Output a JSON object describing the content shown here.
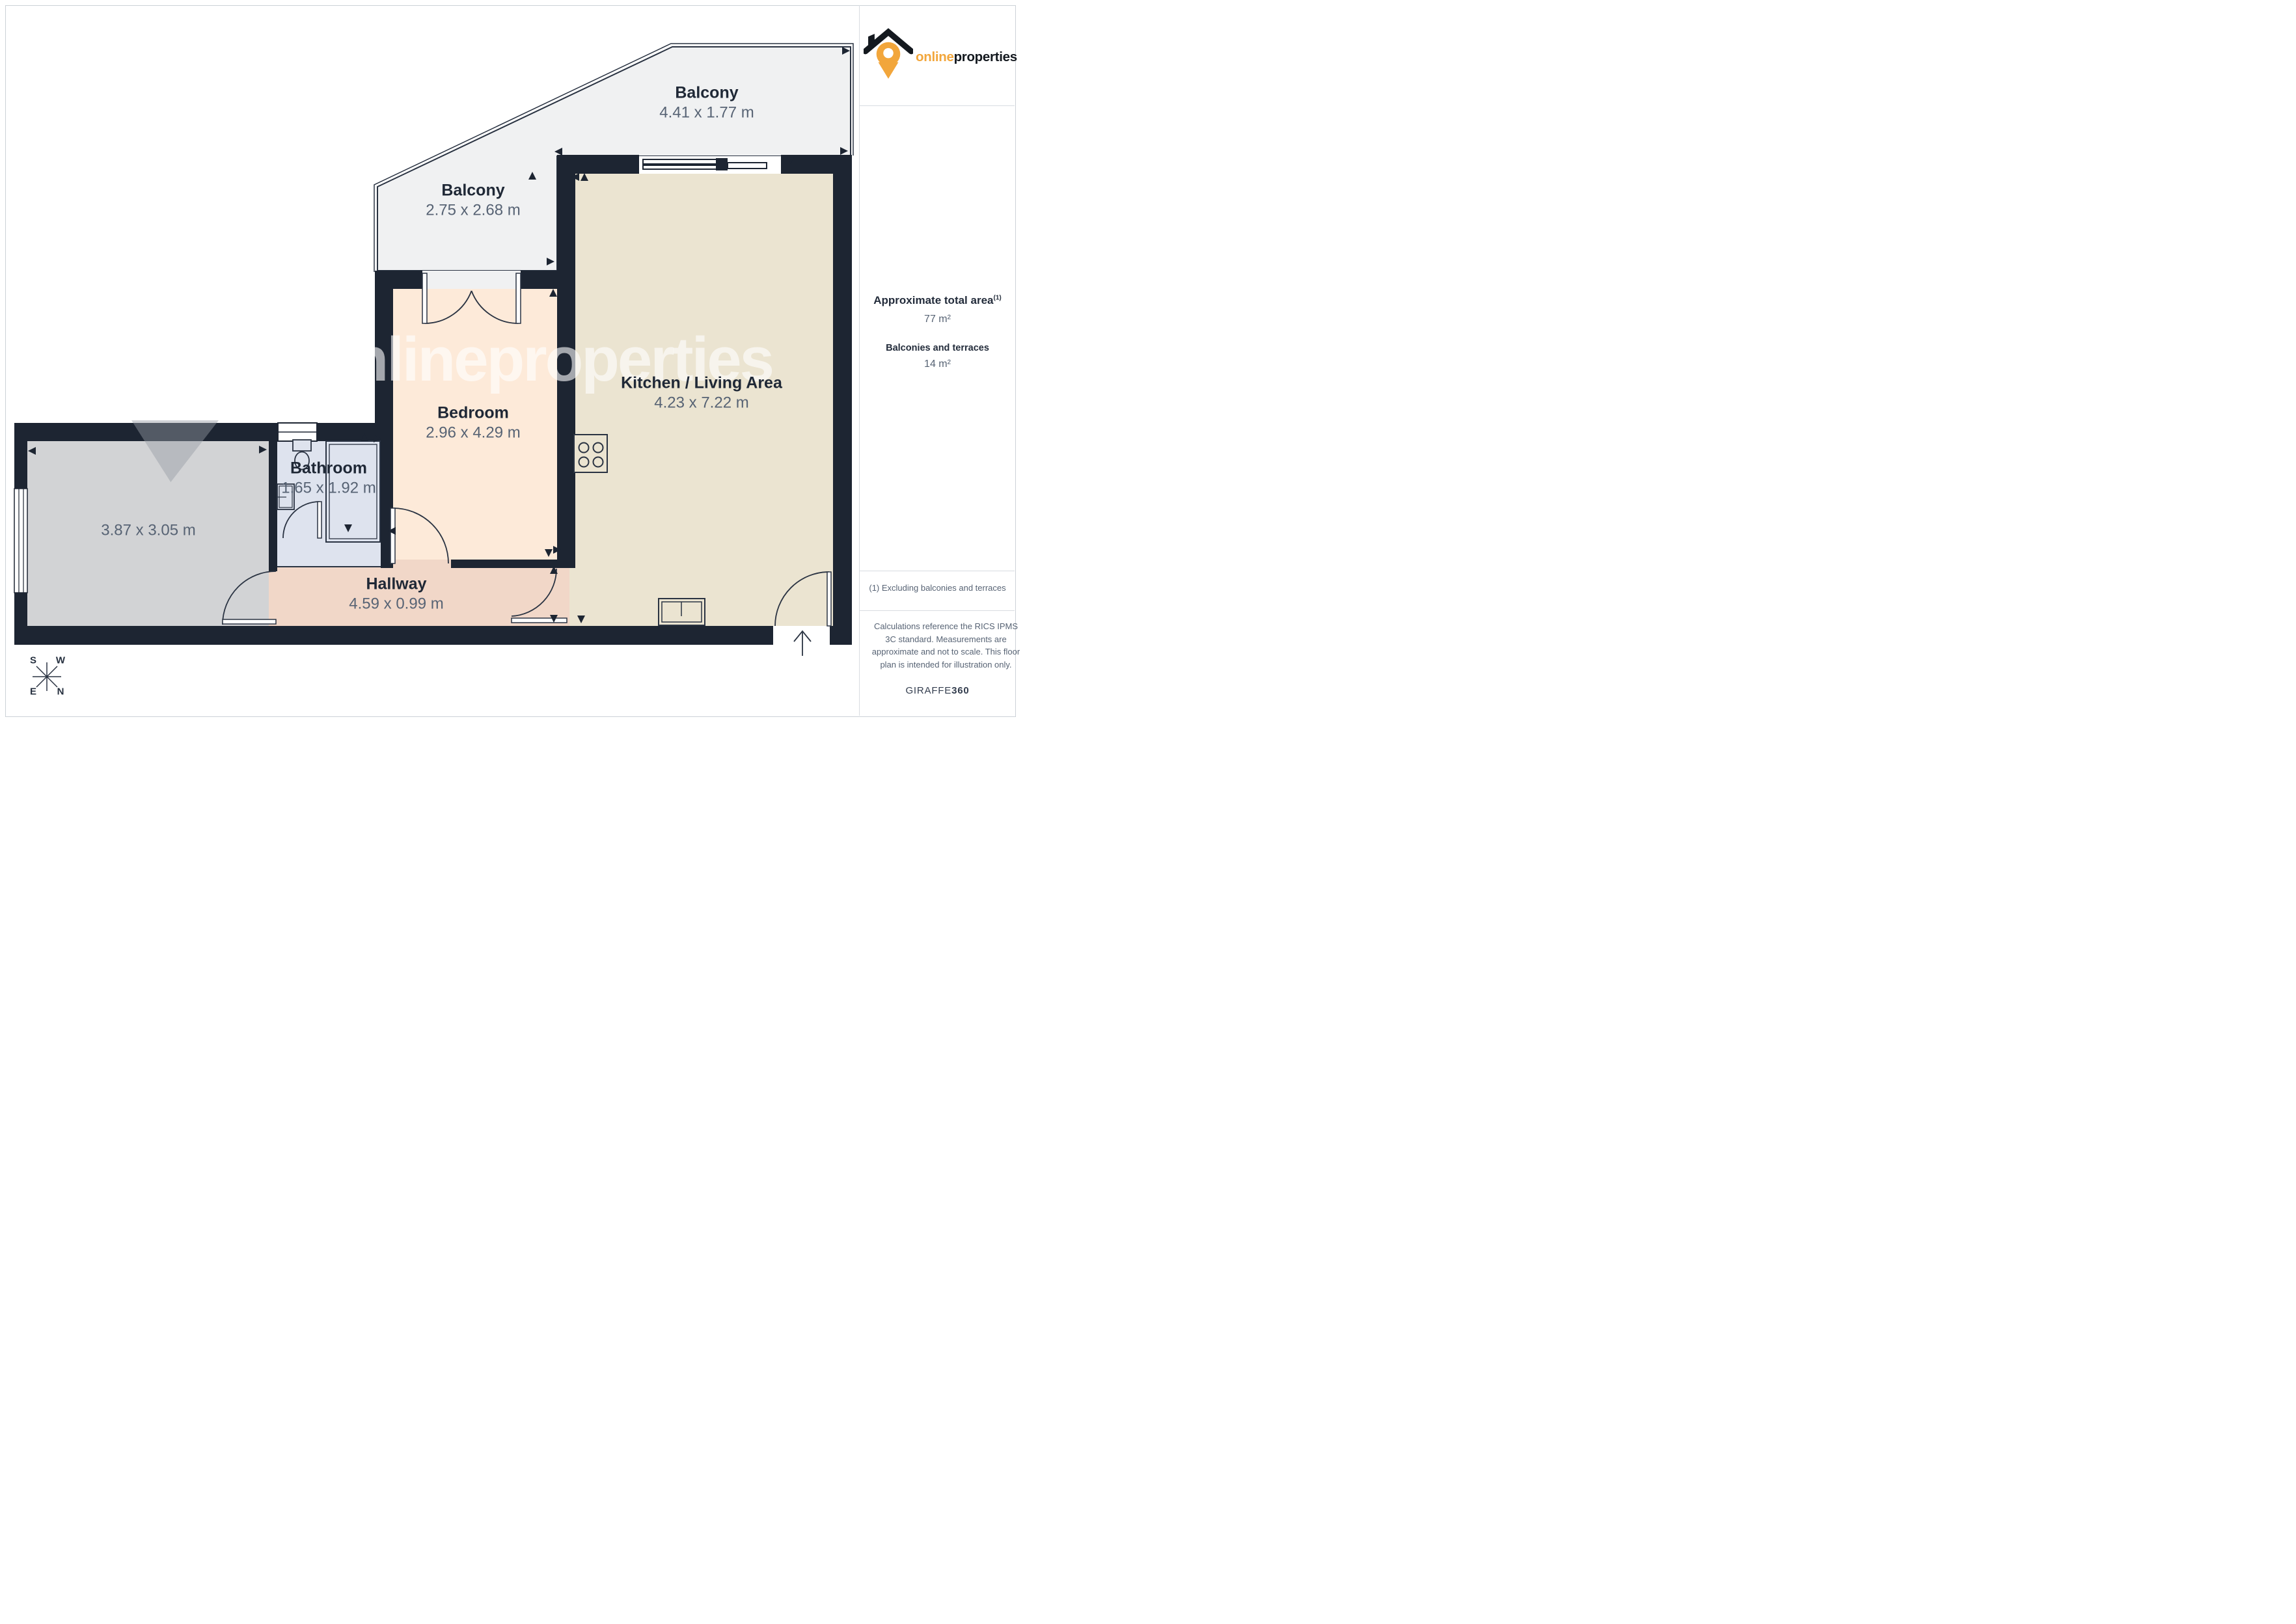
{
  "watermark": {
    "text": "onlineproperties"
  },
  "logo": {
    "online": "online",
    "properties": "properties"
  },
  "rooms": [
    {
      "name": "Balcony",
      "dims": "4.41 x 1.77 m"
    },
    {
      "name": "Balcony",
      "dims": "2.75 x 2.68 m"
    },
    {
      "name": "Kitchen / Living Area",
      "dims": "4.23 x 7.22 m"
    },
    {
      "name": "Bedroom",
      "dims": "2.96 x 4.29 m"
    },
    {
      "name": "Bathroom",
      "dims": "1.65 x 1.92 m"
    },
    {
      "name": "Hallway",
      "dims": "4.59 x 0.99 m"
    },
    {
      "name": "",
      "dims": "3.87 x 3.05 m"
    }
  ],
  "sidebar": {
    "area_title": "Approximate total area",
    "area_footnote_marker": "(1)",
    "area_value": "77 m²",
    "balconies_title": "Balconies and terraces",
    "balconies_value": "14 m²",
    "footnote": "(1) Excluding balconies and terraces",
    "disclaimer": "Calculations reference the RICS IPMS 3C standard. Measurements are approximate and not to scale. This floor plan is intended for illustration only.",
    "brand": {
      "name": "GIRAFFE",
      "suffix": "360"
    }
  },
  "compass": {
    "n": "N",
    "s": "S",
    "e": "E",
    "w": "W"
  },
  "colors": {
    "wall": "#1d2532",
    "accent_orange": "#f2a63b",
    "balcony_fill": "#f0f1f2",
    "kitchen_fill": "#ebe4d1",
    "bedroom_fill": "#fdead9",
    "bathroom_fill": "#dee3ee",
    "hallway_fill": "#f1d7c8",
    "room_fill": "#d2d3d5"
  }
}
